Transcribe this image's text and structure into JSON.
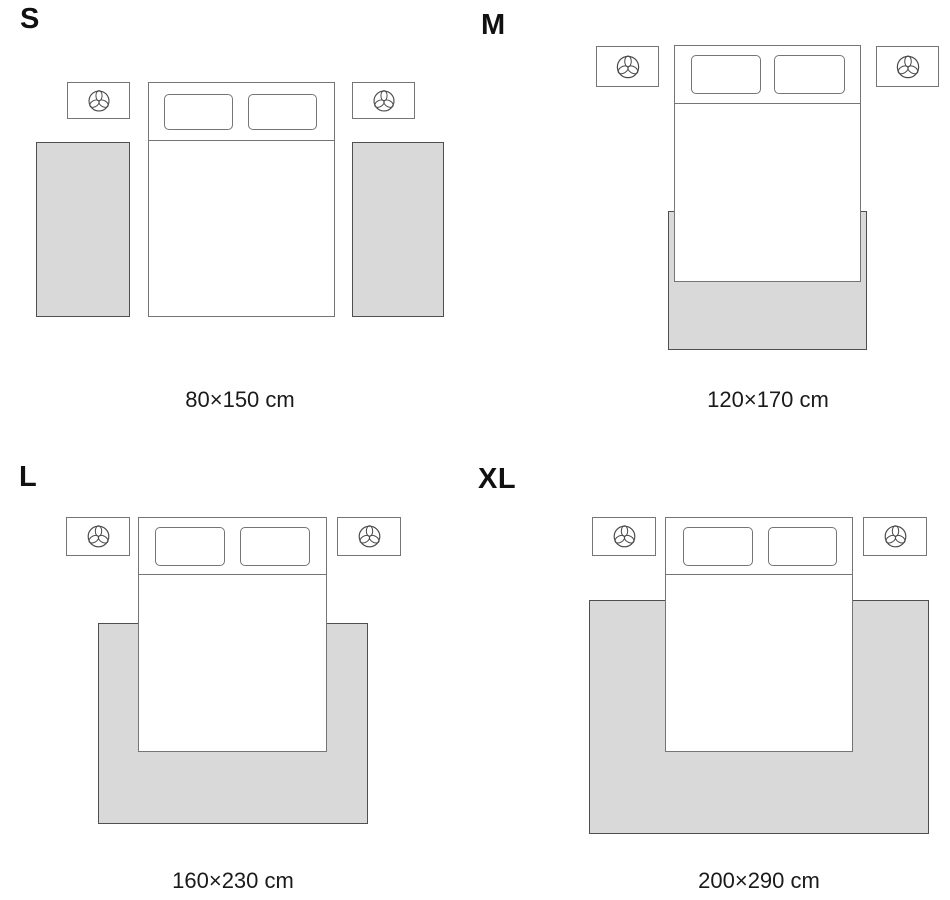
{
  "colors": {
    "background": "#ffffff",
    "rug_fill": "#d9d9d9",
    "rug_border": "#4f4f4f",
    "furniture_border": "#757575",
    "icon_stroke": "#4a4a4a",
    "label_text": "#111111",
    "caption_text": "#1a1a1a"
  },
  "icons": {
    "nightstand_decor": "plant-icon"
  },
  "sizes": [
    {
      "label": "S",
      "dimensions": "80×150 cm",
      "rug_count": 2,
      "placement": "two-runners-beside-bed"
    },
    {
      "label": "M",
      "dimensions": "120×170 cm",
      "rug_count": 1,
      "placement": "under-foot-of-bed"
    },
    {
      "label": "L",
      "dimensions": "160×230 cm",
      "rug_count": 1,
      "placement": "under-lower-two-thirds-of-bed"
    },
    {
      "label": "XL",
      "dimensions": "200×290 cm",
      "rug_count": 1,
      "placement": "under-bed-extending-wide"
    }
  ]
}
